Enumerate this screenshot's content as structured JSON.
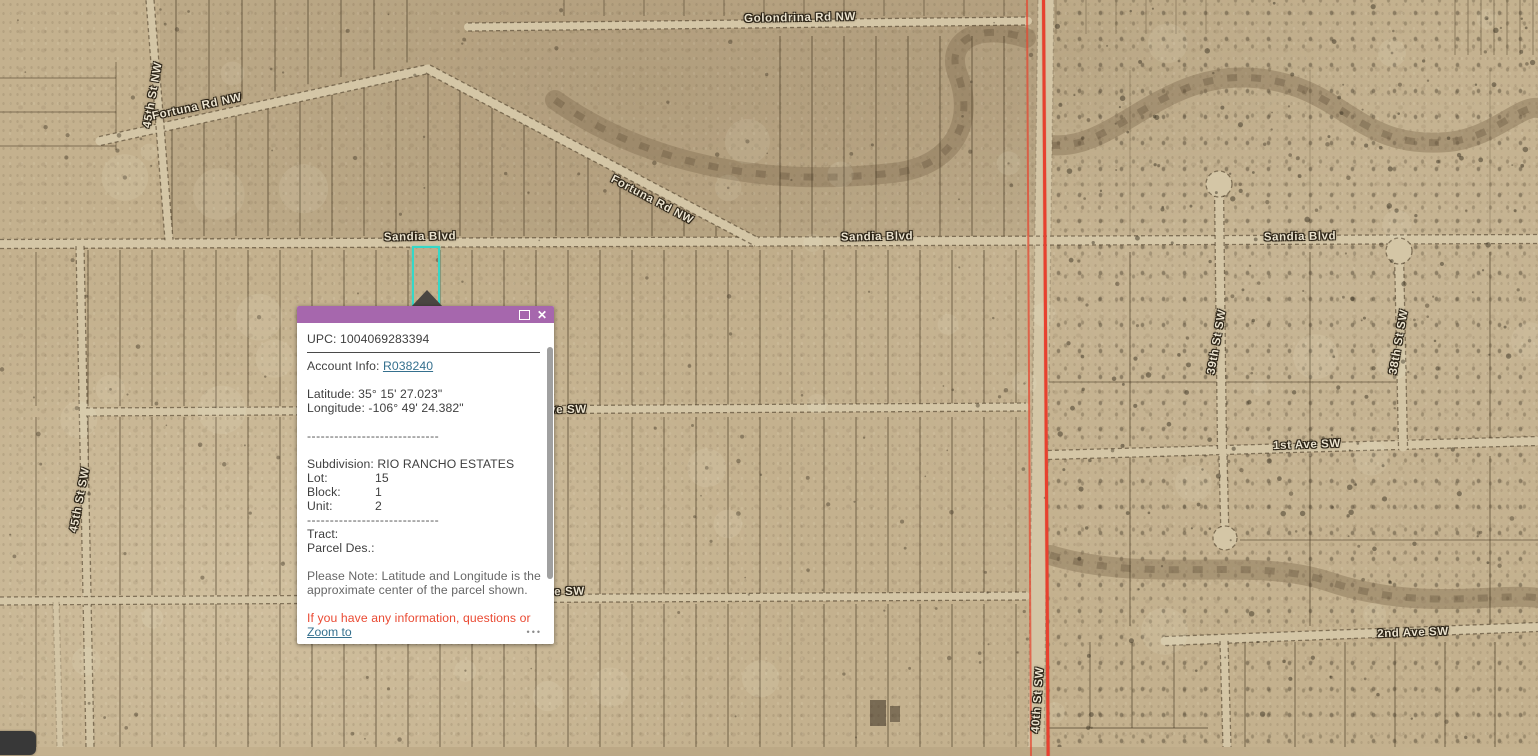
{
  "map": {
    "labels": [
      "Golondrina Rd NW",
      "45th St NW",
      "Fortuna Rd NW",
      "Fortuna Rd NW",
      "Sandia Blvd",
      "Sandia Blvd",
      "Sandia Blvd",
      "ve SW",
      "ve SW",
      "1st Ave SW",
      "2nd Ave SW",
      "39th St SW",
      "38th St SW",
      "45th St SW",
      "40th St SW"
    ],
    "selected_parcel_color": "#35d8c8",
    "boundary_line_color": "#e8402e"
  },
  "popup": {
    "header_color": "#a667ad",
    "close_glyph": "✕",
    "upc": "UPC: 1004069283394",
    "account_label": "Account Info: ",
    "account_link": "R038240",
    "latitude": "Latitude: 35° 15' 27.023\"",
    "longitude": "Longitude: -106° 49' 24.382\"",
    "separator": "-----------------------------",
    "subdivision": "Subdivision: RIO RANCHO ESTATES",
    "fields": [
      {
        "label": "Lot:",
        "value": "15"
      },
      {
        "label": "Block:",
        "value": "1"
      },
      {
        "label": "Unit:",
        "value": "2"
      }
    ],
    "tract_label": "Tract:",
    "parcel_des_label": "Parcel Des.:",
    "note_line1": "Please Note: Latitude and Longitude is the",
    "note_line2": "approximate center of the parcel shown.",
    "alert_text": "If you have any information, questions or",
    "zoom_to": "Zoom to",
    "more_options": "•••"
  }
}
